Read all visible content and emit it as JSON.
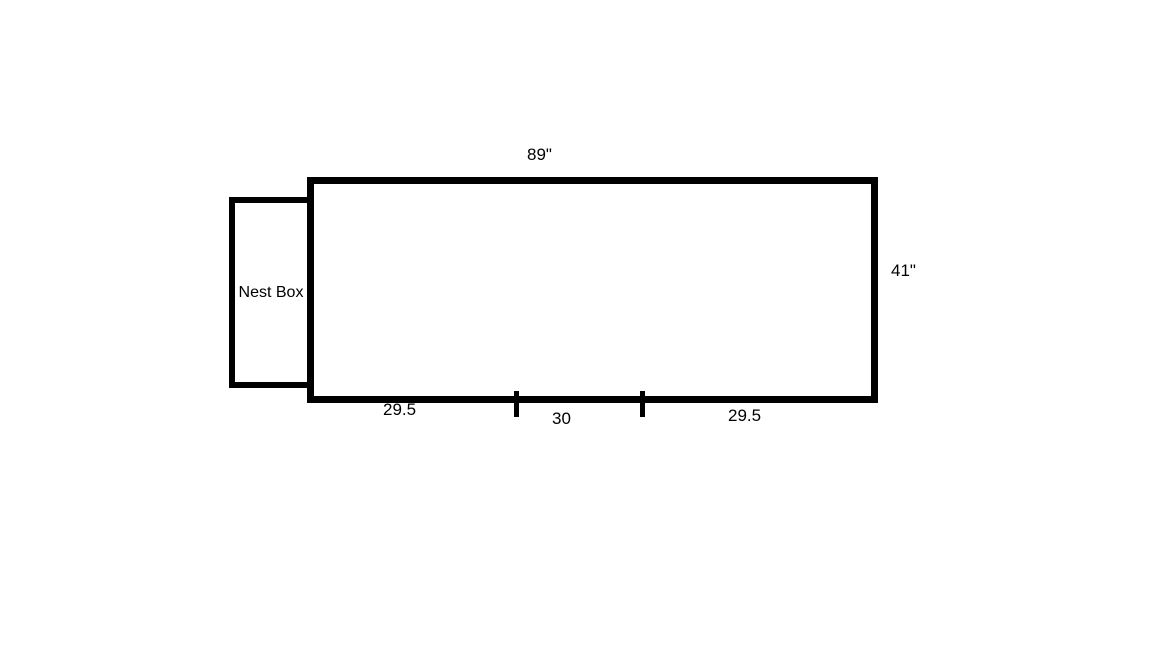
{
  "diagram": {
    "main_box": {
      "top_dimension": "89\"",
      "right_dimension": "41\""
    },
    "nest_box": {
      "label": "Nest Box"
    },
    "bottom_dimensions": {
      "left_segment": "29.5",
      "middle_segment": "30",
      "right_segment": "29.5"
    },
    "colors": {
      "line": "#000000",
      "background": "#ffffff"
    }
  }
}
